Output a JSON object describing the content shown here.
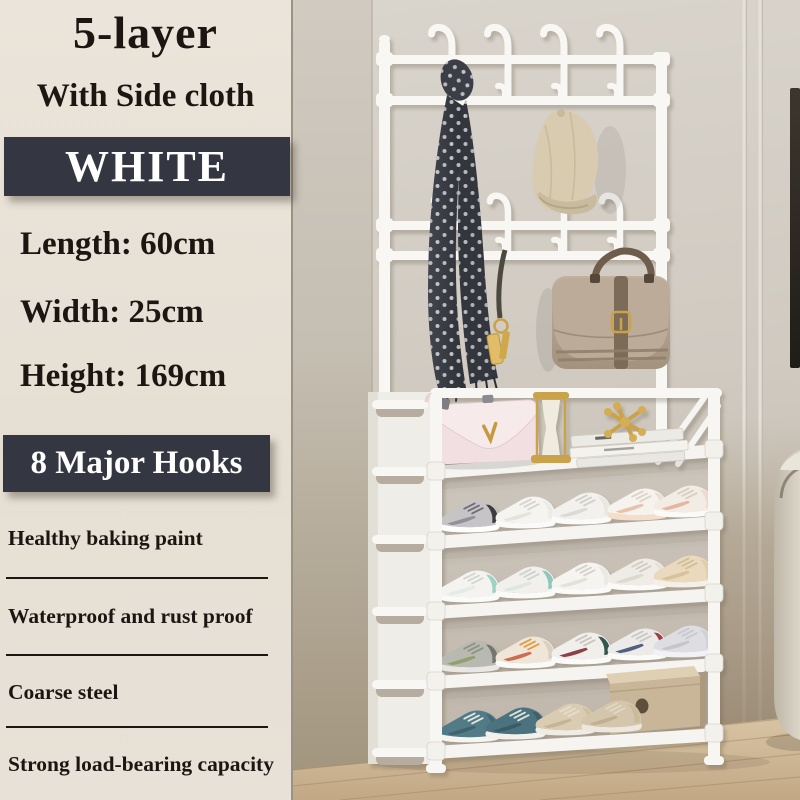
{
  "panel": {
    "title_line1": "5-layer",
    "title_line2": "With Side cloth",
    "color_label": "WHITE",
    "specs": [
      "Length: 60cm",
      "Width: 25cm",
      "Height: 169cm"
    ],
    "hooks_label": "8 Major Hooks",
    "features": [
      "Healthy baking paint",
      "Waterproof and rust proof",
      "Coarse steel",
      "Strong load-bearing capacity"
    ]
  },
  "colors": {
    "panel_bg": "#e5dfd4",
    "banner_bg": "#343741",
    "banner_text": "#ffffff",
    "text": "#1b1611",
    "rack_white": "#f8f7f4",
    "wall": "#d3cdc5",
    "floor_wood": "#cdb493",
    "scarf": "#383a42",
    "cap": "#d8cbb0",
    "leather_bag": "#b4a491",
    "pink_bag": "#f2e0e2",
    "gold_accent": "#c9a24a"
  },
  "scene": {
    "items": [
      "coat-rack-with-hooks",
      "polka-dot-scarf",
      "baseball-cap",
      "key-ring",
      "leather-handbag",
      "five-layer-shoe-rack",
      "pink-handbag",
      "gold-hourglass",
      "gold-ornament",
      "book-stack",
      "sneakers",
      "shoe-box",
      "wood-floor",
      "wardrobe-panel",
      "ottoman"
    ]
  }
}
